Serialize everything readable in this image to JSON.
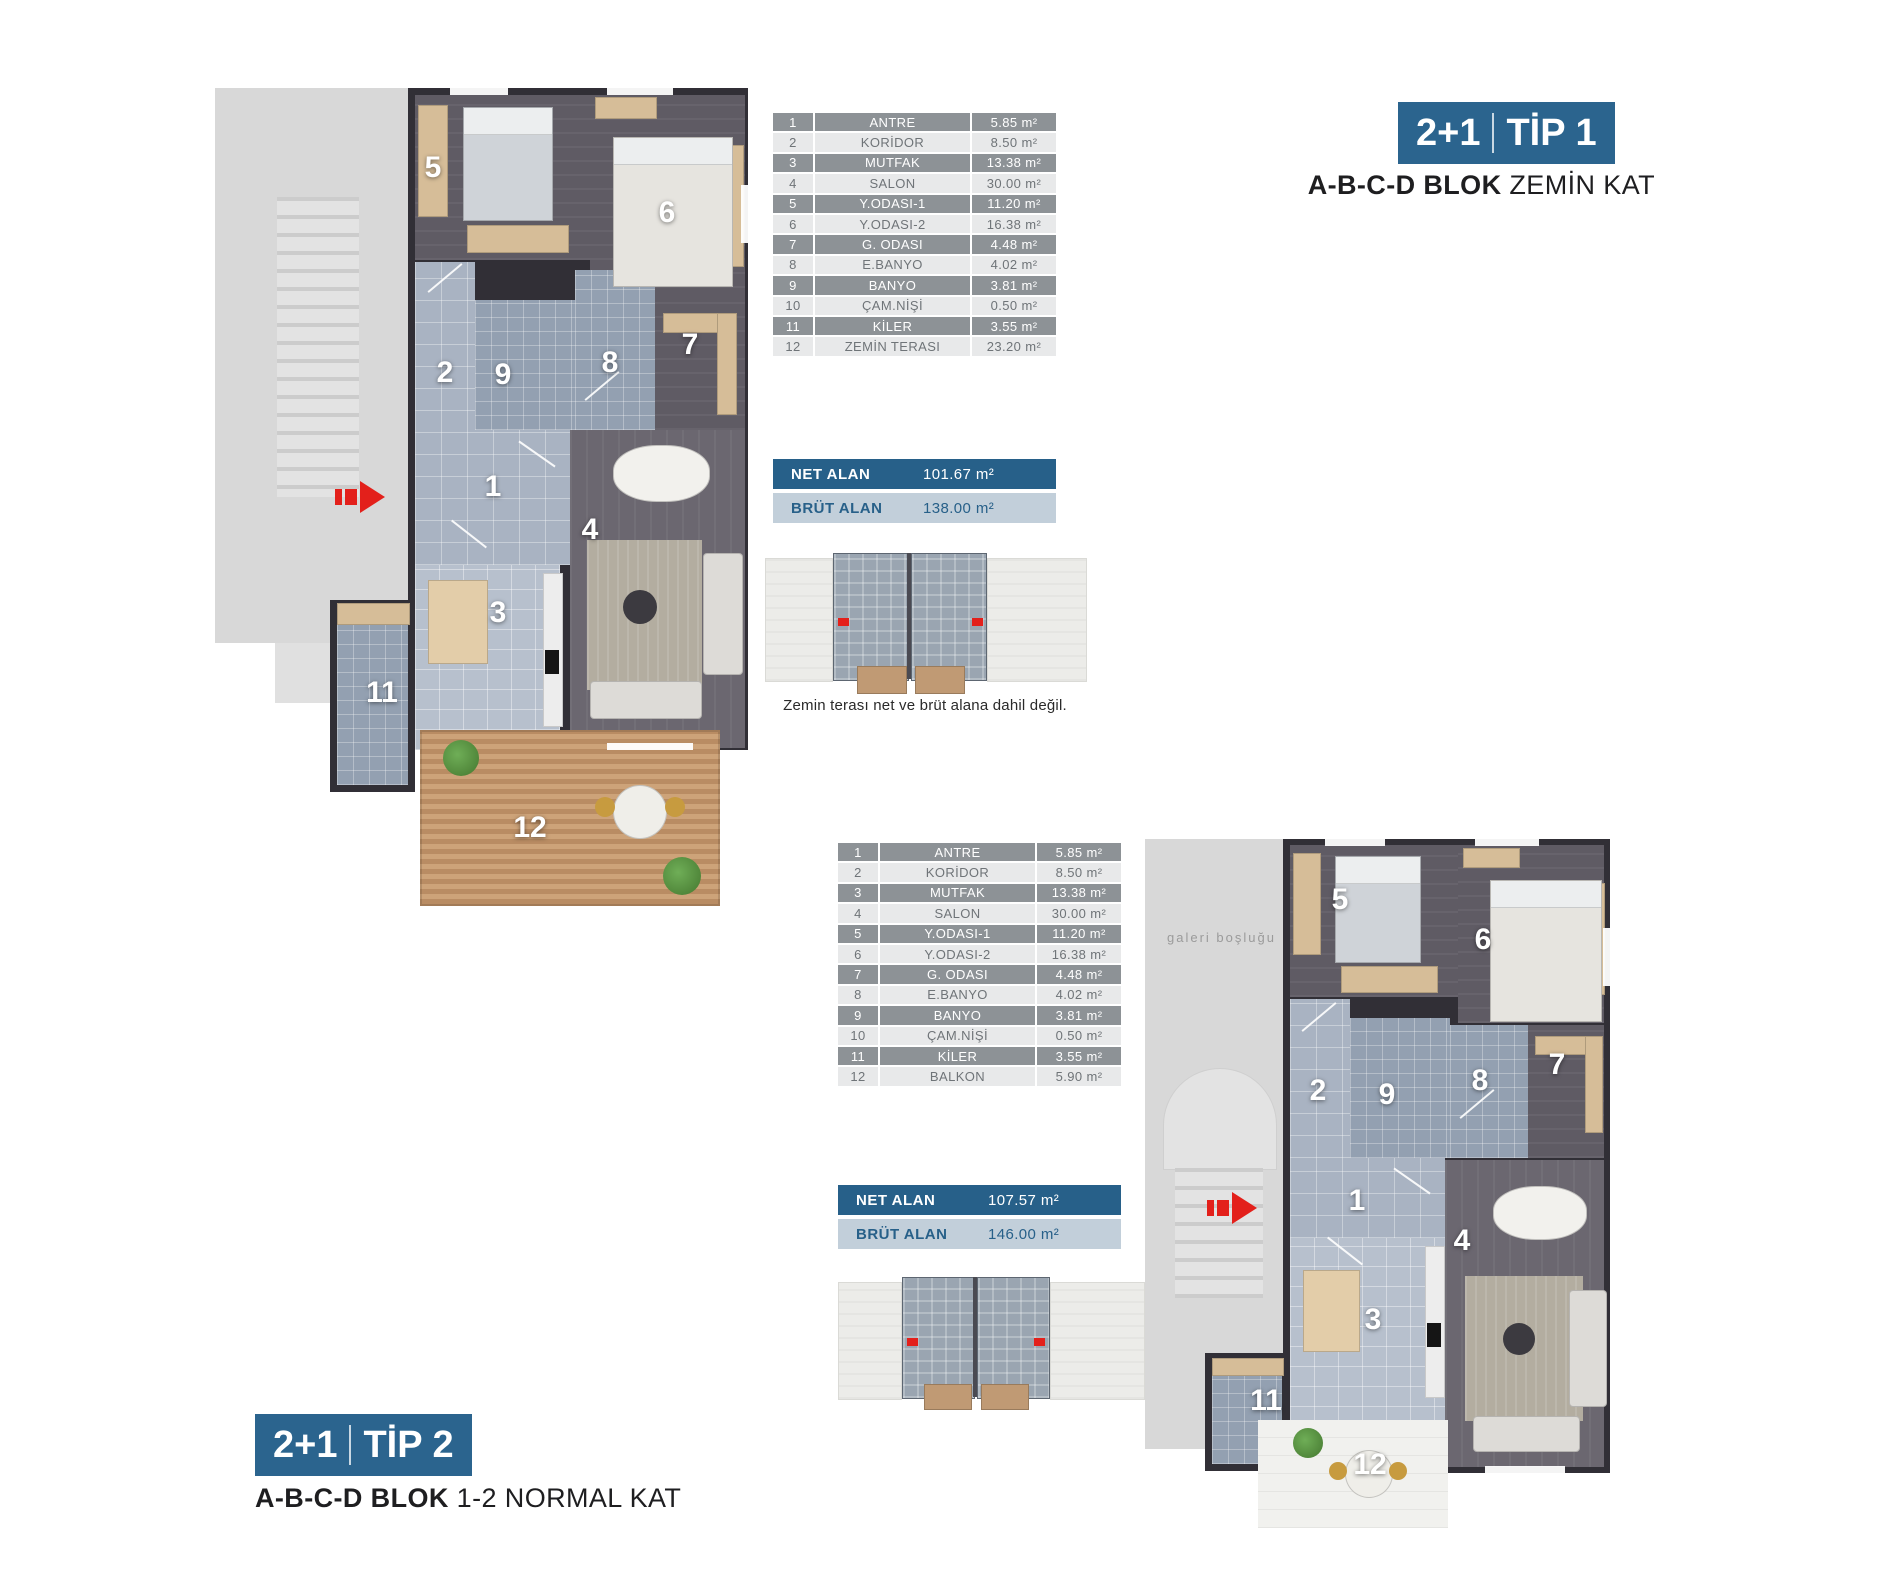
{
  "tip1": {
    "badge": {
      "left": "2+1",
      "type": "TİP 1"
    },
    "subtitle": {
      "bold": "A-B-C-D BLOK",
      "rest": "ZEMİN KAT"
    },
    "rows": [
      {
        "no": "1",
        "name": "ANTRE",
        "area": "5.85 m²"
      },
      {
        "no": "2",
        "name": "KORİDOR",
        "area": "8.50 m²"
      },
      {
        "no": "3",
        "name": "MUTFAK",
        "area": "13.38 m²"
      },
      {
        "no": "4",
        "name": "SALON",
        "area": "30.00 m²"
      },
      {
        "no": "5",
        "name": "Y.ODASI-1",
        "area": "11.20 m²"
      },
      {
        "no": "6",
        "name": "Y.ODASI-2",
        "area": "16.38 m²"
      },
      {
        "no": "7",
        "name": "G. ODASI",
        "area": "4.48 m²"
      },
      {
        "no": "8",
        "name": "E.BANYO",
        "area": "4.02 m²"
      },
      {
        "no": "9",
        "name": "BANYO",
        "area": "3.81 m²"
      },
      {
        "no": "10",
        "name": "ÇAM.NİŞİ",
        "area": "0.50 m²"
      },
      {
        "no": "11",
        "name": "KİLER",
        "area": "3.55 m²"
      },
      {
        "no": "12",
        "name": "ZEMİN TERASI",
        "area": "23.20 m²"
      }
    ],
    "net_label": "NET ALAN",
    "net_value": "101.67 m²",
    "brut_label": "BRÜT ALAN",
    "brut_value": "138.00 m²",
    "note": "Zemin terası net ve brüt alana dahil değil.",
    "room_numbers": [
      "5",
      "6",
      "2",
      "9",
      "8",
      "7",
      "1",
      "4",
      "3",
      "11",
      "12"
    ]
  },
  "tip2": {
    "badge": {
      "left": "2+1",
      "type": "TİP 2"
    },
    "subtitle": {
      "bold": "A-B-C-D BLOK",
      "rest": "1-2 NORMAL KAT"
    },
    "rows": [
      {
        "no": "1",
        "name": "ANTRE",
        "area": "5.85 m²"
      },
      {
        "no": "2",
        "name": "KORİDOR",
        "area": "8.50 m²"
      },
      {
        "no": "3",
        "name": "MUTFAK",
        "area": "13.38 m²"
      },
      {
        "no": "4",
        "name": "SALON",
        "area": "30.00 m²"
      },
      {
        "no": "5",
        "name": "Y.ODASI-1",
        "area": "11.20 m²"
      },
      {
        "no": "6",
        "name": "Y.ODASI-2",
        "area": "16.38 m²"
      },
      {
        "no": "7",
        "name": "G. ODASI",
        "area": "4.48 m²"
      },
      {
        "no": "8",
        "name": "E.BANYO",
        "area": "4.02 m²"
      },
      {
        "no": "9",
        "name": "BANYO",
        "area": "3.81 m²"
      },
      {
        "no": "10",
        "name": "ÇAM.NİŞİ",
        "area": "0.50 m²"
      },
      {
        "no": "11",
        "name": "KİLER",
        "area": "3.55 m²"
      },
      {
        "no": "12",
        "name": "BALKON",
        "area": "5.90 m²"
      }
    ],
    "net_label": "NET ALAN",
    "net_value": "107.57 m²",
    "brut_label": "BRÜT ALAN",
    "brut_value": "146.00 m²",
    "galeri_text": "galeri boşluğu",
    "room_numbers": [
      "5",
      "6",
      "7",
      "2",
      "9",
      "8",
      "1",
      "4",
      "3",
      "11",
      "12"
    ]
  },
  "colors": {
    "accent": "#2b648e",
    "net_bar": "#276089",
    "brut_bar": "#c2cfda",
    "table_row_dark": "#8d9296",
    "table_row_light": "#e8e9ea",
    "entrance_red": "#e3201b"
  }
}
